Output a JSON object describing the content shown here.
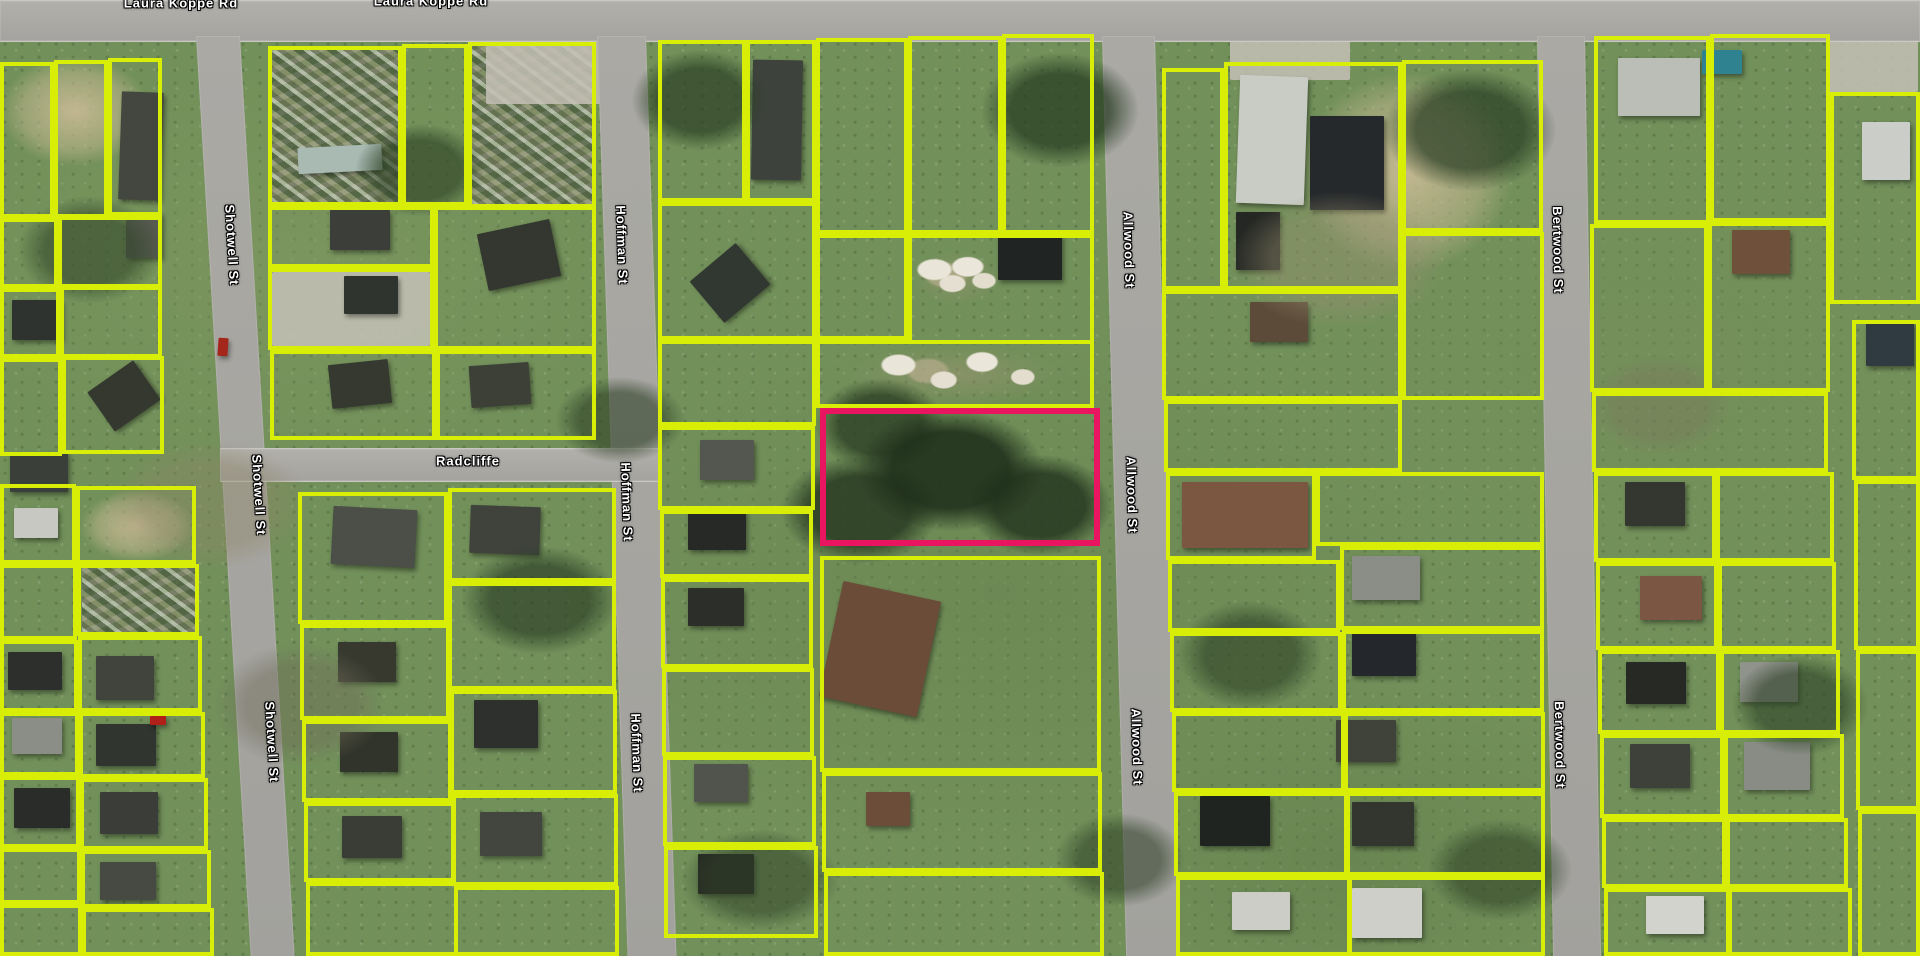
{
  "map": {
    "type": "aerial-parcel-map",
    "colors": {
      "parcel_outline": "#d9ee07",
      "highlight_outline": "#ea1560",
      "road": "#a6a5a1",
      "grass_base": "#72905a"
    },
    "street_labels": [
      {
        "text": "Laura Koppe Rd",
        "x": 181,
        "y": 3,
        "rot": 0
      },
      {
        "text": "Laura Koppe Rd",
        "x": 431,
        "y": 1,
        "rot": 0
      },
      {
        "text": "Shotwell St",
        "x": 232,
        "y": 245,
        "rot": 86.6
      },
      {
        "text": "Shotwell St",
        "x": 259,
        "y": 495,
        "rot": 86.6
      },
      {
        "text": "Shotwell St",
        "x": 272,
        "y": 742,
        "rot": 86.6
      },
      {
        "text": "Hoffman St",
        "x": 622,
        "y": 245,
        "rot": 88.1
      },
      {
        "text": "Hoffman St",
        "x": 627,
        "y": 502,
        "rot": 88.1
      },
      {
        "text": "Hoffman St",
        "x": 637,
        "y": 753,
        "rot": 88.1
      },
      {
        "text": "Radcliffe",
        "x": 468,
        "y": 461,
        "rot": 0
      },
      {
        "text": "Allwood St",
        "x": 1129,
        "y": 250,
        "rot": 88.5
      },
      {
        "text": "Allwood St",
        "x": 1132,
        "y": 495,
        "rot": 88.5
      },
      {
        "text": "Allwood St",
        "x": 1137,
        "y": 747,
        "rot": 88.5
      },
      {
        "text": "Bertwood St",
        "x": 1558,
        "y": 250,
        "rot": 89
      },
      {
        "text": "Bertwood St",
        "x": 1560,
        "y": 745,
        "rot": 89
      }
    ],
    "roads": [
      {
        "name": "Laura Koppe Rd",
        "x": 0,
        "y": 0,
        "w": 1920,
        "h": 40,
        "skew": 0,
        "horizontal": true
      },
      {
        "name": "Shotwell St",
        "x": 196,
        "y": 36,
        "w": 44,
        "h": 940,
        "skew": 3.4,
        "horizontal": false
      },
      {
        "name": "Hoffman St",
        "x": 597,
        "y": 36,
        "w": 49,
        "h": 940,
        "skew": 1.9,
        "horizontal": false
      },
      {
        "name": "Radcliffe",
        "x": 220,
        "y": 448,
        "w": 442,
        "h": 32,
        "skew": 0,
        "horizontal": true
      },
      {
        "name": "Allwood St",
        "x": 1102,
        "y": 36,
        "w": 53,
        "h": 940,
        "skew": 1.5,
        "horizontal": false
      },
      {
        "name": "Bertwood St",
        "x": 1537,
        "y": 36,
        "w": 48,
        "h": 940,
        "skew": 1.0,
        "horizontal": false
      }
    ],
    "highlight_parcel": {
      "x": 820,
      "y": 408,
      "w": 280,
      "h": 138
    },
    "parcels": [
      [
        0,
        62,
        54,
        156
      ],
      [
        54,
        60,
        54,
        158
      ],
      [
        108,
        58,
        54,
        158
      ],
      [
        0,
        218,
        58,
        70
      ],
      [
        58,
        216,
        104,
        72
      ],
      [
        0,
        288,
        60,
        70
      ],
      [
        60,
        286,
        102,
        72
      ],
      [
        0,
        358,
        62,
        98
      ],
      [
        62,
        356,
        102,
        98
      ],
      [
        0,
        484,
        76,
        80
      ],
      [
        76,
        486,
        120,
        78
      ],
      [
        0,
        564,
        77,
        76
      ],
      [
        77,
        564,
        122,
        72
      ],
      [
        0,
        640,
        78,
        72
      ],
      [
        78,
        636,
        124,
        76
      ],
      [
        0,
        712,
        79,
        64
      ],
      [
        79,
        712,
        126,
        66
      ],
      [
        0,
        776,
        80,
        72
      ],
      [
        80,
        778,
        128,
        72
      ],
      [
        0,
        848,
        81,
        56
      ],
      [
        81,
        850,
        130,
        58
      ],
      [
        0,
        904,
        82,
        52
      ],
      [
        82,
        908,
        132,
        48
      ],
      [
        268,
        46,
        134,
        160
      ],
      [
        402,
        44,
        66,
        162
      ],
      [
        468,
        42,
        128,
        166
      ],
      [
        268,
        206,
        166,
        62
      ],
      [
        434,
        206,
        162,
        144
      ],
      [
        268,
        268,
        166,
        82
      ],
      [
        270,
        350,
        166,
        90
      ],
      [
        436,
        350,
        160,
        90
      ],
      [
        298,
        492,
        150,
        132
      ],
      [
        448,
        488,
        168,
        94
      ],
      [
        448,
        582,
        168,
        108
      ],
      [
        300,
        624,
        150,
        96
      ],
      [
        450,
        690,
        167,
        104
      ],
      [
        302,
        720,
        150,
        82
      ],
      [
        304,
        802,
        151,
        80
      ],
      [
        452,
        794,
        166,
        92
      ],
      [
        306,
        882,
        152,
        74
      ],
      [
        454,
        886,
        165,
        70
      ],
      [
        658,
        40,
        88,
        162
      ],
      [
        746,
        40,
        70,
        162
      ],
      [
        816,
        38,
        92,
        196
      ],
      [
        908,
        36,
        94,
        198
      ],
      [
        1002,
        34,
        92,
        200
      ],
      [
        658,
        202,
        158,
        138
      ],
      [
        816,
        234,
        92,
        106
      ],
      [
        908,
        234,
        186,
        110
      ],
      [
        658,
        340,
        158,
        86
      ],
      [
        816,
        340,
        278,
        68
      ],
      [
        658,
        426,
        157,
        84
      ],
      [
        660,
        510,
        153,
        68
      ],
      [
        661,
        578,
        152,
        90
      ],
      [
        662,
        668,
        152,
        88
      ],
      [
        663,
        756,
        153,
        90
      ],
      [
        664,
        846,
        154,
        92
      ],
      [
        820,
        556,
        281,
        216
      ],
      [
        822,
        772,
        280,
        100
      ],
      [
        824,
        872,
        280,
        84
      ],
      [
        1162,
        68,
        62,
        222
      ],
      [
        1224,
        62,
        178,
        228
      ],
      [
        1402,
        60,
        141,
        172
      ],
      [
        1402,
        232,
        142,
        168
      ],
      [
        1162,
        290,
        240,
        110
      ],
      [
        1164,
        400,
        238,
        72
      ],
      [
        1166,
        472,
        150,
        88
      ],
      [
        1316,
        472,
        228,
        74
      ],
      [
        1340,
        546,
        204,
        84
      ],
      [
        1168,
        560,
        172,
        72
      ],
      [
        1170,
        632,
        172,
        80
      ],
      [
        1342,
        630,
        202,
        82
      ],
      [
        1172,
        712,
        173,
        80
      ],
      [
        1344,
        712,
        201,
        80
      ],
      [
        1174,
        792,
        174,
        84
      ],
      [
        1346,
        792,
        199,
        84
      ],
      [
        1176,
        876,
        175,
        80
      ],
      [
        1348,
        876,
        197,
        80
      ],
      [
        1594,
        36,
        116,
        188
      ],
      [
        1710,
        34,
        120,
        188
      ],
      [
        1830,
        92,
        90,
        212
      ],
      [
        1590,
        224,
        118,
        168
      ],
      [
        1708,
        222,
        122,
        170
      ],
      [
        1592,
        392,
        236,
        80
      ],
      [
        1594,
        472,
        122,
        90
      ],
      [
        1716,
        472,
        118,
        90
      ],
      [
        1596,
        562,
        122,
        88
      ],
      [
        1718,
        562,
        118,
        88
      ],
      [
        1598,
        650,
        122,
        84
      ],
      [
        1720,
        650,
        120,
        84
      ],
      [
        1600,
        734,
        124,
        84
      ],
      [
        1724,
        734,
        120,
        84
      ],
      [
        1602,
        818,
        124,
        70
      ],
      [
        1726,
        818,
        122,
        70
      ],
      [
        1604,
        888,
        126,
        68
      ],
      [
        1728,
        888,
        124,
        68
      ],
      [
        1852,
        320,
        68,
        160
      ],
      [
        1854,
        480,
        66,
        170
      ],
      [
        1856,
        650,
        64,
        160
      ],
      [
        1858,
        810,
        62,
        146
      ]
    ],
    "ground": [
      {
        "x": 0,
        "y": 56,
        "w": 150,
        "h": 110,
        "kind": "dirt"
      },
      {
        "x": 272,
        "y": 50,
        "w": 126,
        "h": 152,
        "kind": "clutter"
      },
      {
        "x": 472,
        "y": 46,
        "w": 120,
        "h": 158,
        "kind": "clutter"
      },
      {
        "x": 80,
        "y": 490,
        "w": 114,
        "h": 72,
        "kind": "dirt"
      },
      {
        "x": 82,
        "y": 566,
        "w": 114,
        "h": 66,
        "kind": "clutter"
      },
      {
        "x": 272,
        "y": 272,
        "w": 158,
        "h": 74,
        "kind": "concrete"
      },
      {
        "x": 486,
        "y": 40,
        "w": 160,
        "h": 64,
        "kind": "concrete"
      },
      {
        "x": 1230,
        "y": 40,
        "w": 120,
        "h": 40,
        "kind": "concrete"
      },
      {
        "x": 842,
        "y": 344,
        "w": 226,
        "h": 60,
        "kind": "sand"
      },
      {
        "x": 912,
        "y": 250,
        "w": 90,
        "h": 56,
        "kind": "sand"
      },
      {
        "x": 1300,
        "y": 72,
        "w": 214,
        "h": 200,
        "kind": "dirt"
      },
      {
        "x": 1828,
        "y": 40,
        "w": 90,
        "h": 52,
        "kind": "concrete"
      }
    ],
    "buildings": [
      [
        120,
        92,
        42,
        108,
        "#44473f",
        2
      ],
      [
        126,
        212,
        36,
        46,
        "#565a50",
        0
      ],
      [
        12,
        300,
        50,
        40,
        "#2f3330",
        0
      ],
      [
        96,
        372,
        56,
        48,
        "#34382f",
        -35
      ],
      [
        10,
        452,
        58,
        40,
        "#3b3f39",
        0
      ],
      [
        14,
        508,
        44,
        30,
        "#c6c8c1",
        0
      ],
      [
        8,
        652,
        54,
        38,
        "#2c2f2b",
        0
      ],
      [
        96,
        656,
        58,
        44,
        "#40443c",
        0
      ],
      [
        12,
        718,
        50,
        36,
        "#8b8e87",
        0
      ],
      [
        96,
        724,
        60,
        42,
        "#31352f",
        0
      ],
      [
        14,
        788,
        56,
        40,
        "#292c29",
        0
      ],
      [
        100,
        792,
        58,
        42,
        "#3b3e38",
        0
      ],
      [
        100,
        862,
        56,
        38,
        "#464a42",
        0
      ],
      [
        298,
        146,
        84,
        26,
        "#a8bab2",
        -3
      ],
      [
        330,
        210,
        60,
        40,
        "#3c3f39",
        0
      ],
      [
        344,
        276,
        54,
        38,
        "#30342e",
        0
      ],
      [
        482,
        226,
        74,
        58,
        "#34372f",
        -12
      ],
      [
        330,
        362,
        60,
        44,
        "#35392f",
        -6
      ],
      [
        470,
        364,
        60,
        42,
        "#3d4037",
        -4
      ],
      [
        332,
        508,
        84,
        58,
        "#4b4f47",
        3
      ],
      [
        470,
        506,
        70,
        48,
        "#3f433b",
        2
      ],
      [
        338,
        642,
        58,
        40,
        "#37392f",
        0
      ],
      [
        474,
        700,
        64,
        48,
        "#2d302c",
        0
      ],
      [
        340,
        732,
        58,
        40,
        "#31342a",
        0
      ],
      [
        342,
        816,
        60,
        42,
        "#3a3d35",
        0
      ],
      [
        480,
        812,
        62,
        44,
        "#43463e",
        0
      ],
      [
        752,
        60,
        50,
        120,
        "#3e423c",
        1
      ],
      [
        700,
        256,
        60,
        54,
        "#313731",
        -40
      ],
      [
        998,
        234,
        64,
        46,
        "#202523",
        0
      ],
      [
        700,
        440,
        54,
        40,
        "#54574f",
        0
      ],
      [
        688,
        510,
        58,
        40,
        "#262925",
        0
      ],
      [
        688,
        588,
        56,
        38,
        "#2b2e29",
        0
      ],
      [
        694,
        764,
        54,
        38,
        "#51544c",
        0
      ],
      [
        698,
        854,
        56,
        40,
        "#252823",
        0
      ],
      [
        830,
        590,
        100,
        118,
        "#6b4c38",
        12
      ],
      [
        866,
        792,
        44,
        34,
        "#6b4d39",
        0
      ],
      [
        1238,
        76,
        68,
        128,
        "#c8ccc5",
        2
      ],
      [
        1310,
        116,
        74,
        94,
        "#26292b",
        0
      ],
      [
        1236,
        212,
        44,
        58,
        "#242723",
        0
      ],
      [
        1250,
        302,
        58,
        40,
        "#5c4b39",
        0
      ],
      [
        1182,
        482,
        126,
        66,
        "#7b5741",
        0
      ],
      [
        1352,
        556,
        68,
        44,
        "#8b8e86",
        0
      ],
      [
        1352,
        632,
        64,
        44,
        "#24272b",
        0
      ],
      [
        1336,
        720,
        60,
        42,
        "#40433a",
        0
      ],
      [
        1200,
        796,
        70,
        50,
        "#1f2421",
        0
      ],
      [
        1352,
        802,
        62,
        44,
        "#33362e",
        0
      ],
      [
        1232,
        892,
        58,
        38,
        "#cbcdc6",
        0
      ],
      [
        1352,
        888,
        70,
        50,
        "#cdcfc8",
        0
      ],
      [
        1618,
        58,
        82,
        58,
        "#babeb7",
        0
      ],
      [
        1702,
        50,
        40,
        24,
        "#2f8391",
        0
      ],
      [
        1732,
        230,
        58,
        44,
        "#6f503b",
        0
      ],
      [
        1625,
        482,
        60,
        44,
        "#34372f",
        0
      ],
      [
        1640,
        576,
        62,
        44,
        "#7b5743",
        0
      ],
      [
        1626,
        662,
        60,
        42,
        "#262924",
        0
      ],
      [
        1740,
        662,
        58,
        40,
        "#90938b",
        0
      ],
      [
        1630,
        744,
        60,
        44,
        "#3e4139",
        0
      ],
      [
        1744,
        742,
        66,
        48,
        "#898c84",
        0
      ],
      [
        1646,
        896,
        58,
        38,
        "#d1d3cc",
        0
      ],
      [
        1862,
        122,
        48,
        58,
        "#cbcdc8",
        0
      ],
      [
        1866,
        322,
        48,
        44,
        "#2f3b40",
        0
      ],
      [
        218,
        338,
        10,
        18,
        "#a5271c",
        4
      ],
      [
        150,
        716,
        16,
        9,
        "#b02018",
        0
      ]
    ]
  }
}
